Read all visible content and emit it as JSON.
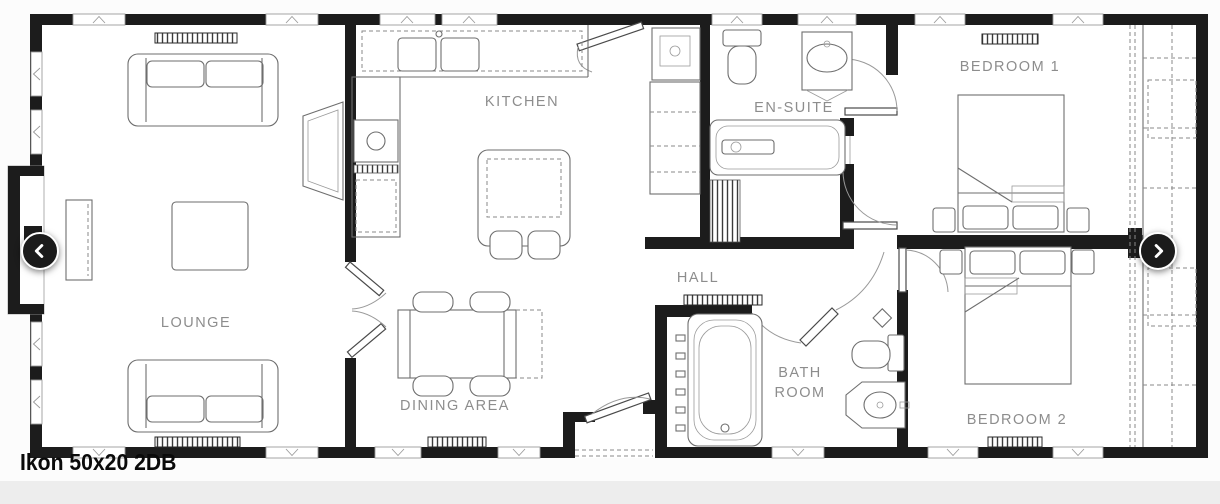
{
  "title": "Ikon 50x20 2DB",
  "rooms": {
    "lounge": "LOUNGE",
    "kitchen": "KITCHEN",
    "dining": "DINING AREA",
    "hall": "HALL",
    "ensuite": "EN-SUITE",
    "bath_line1": "BATH",
    "bath_line2": "ROOM",
    "bedroom1": "BEDROOM 1",
    "bedroom2": "BEDROOM 2"
  },
  "carousel": {
    "prev_icon": "chevron-left",
    "next_icon": "chevron-right"
  },
  "colors": {
    "wall": "#1c1c1c",
    "label": "#8d8d8d",
    "page_bg": "#fcfcfc",
    "plan_bg": "#ffffff",
    "footer_band": "#ededed",
    "arrow_bg": "#1b1b1b",
    "arrow_fg": "#ffffff"
  }
}
